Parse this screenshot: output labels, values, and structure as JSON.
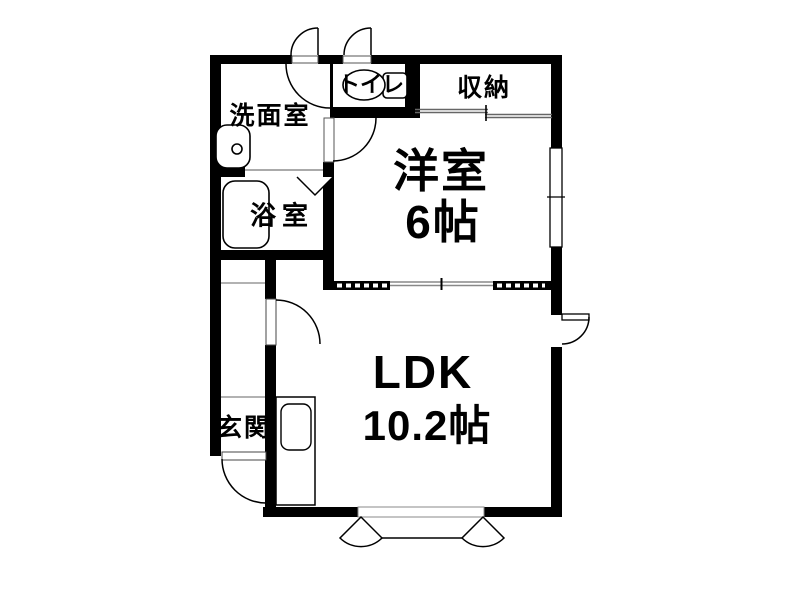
{
  "plan": {
    "type": "apartment-floor-plan",
    "rooms": {
      "washroom": {
        "label": "洗面室"
      },
      "toilet": {
        "label": "トイレ"
      },
      "storage": {
        "label": "収納"
      },
      "western_room": {
        "label": "洋室",
        "size": "6帖"
      },
      "bathroom": {
        "label": "浴室"
      },
      "entrance": {
        "label": "玄関"
      },
      "ldk": {
        "label": "LDK",
        "size": "10.2帖"
      }
    },
    "fixtures": {
      "washbasin": "sink-basin-icon",
      "bathtub": "bathtub-icon",
      "toilet_bowl": "toilet-bowl-icon",
      "kitchen_counter": "kitchen-sink-counter-icon"
    },
    "colors": {
      "wall": "#000000",
      "background": "#ffffff",
      "thin_line": "#777777",
      "step_line": "#999999"
    }
  }
}
